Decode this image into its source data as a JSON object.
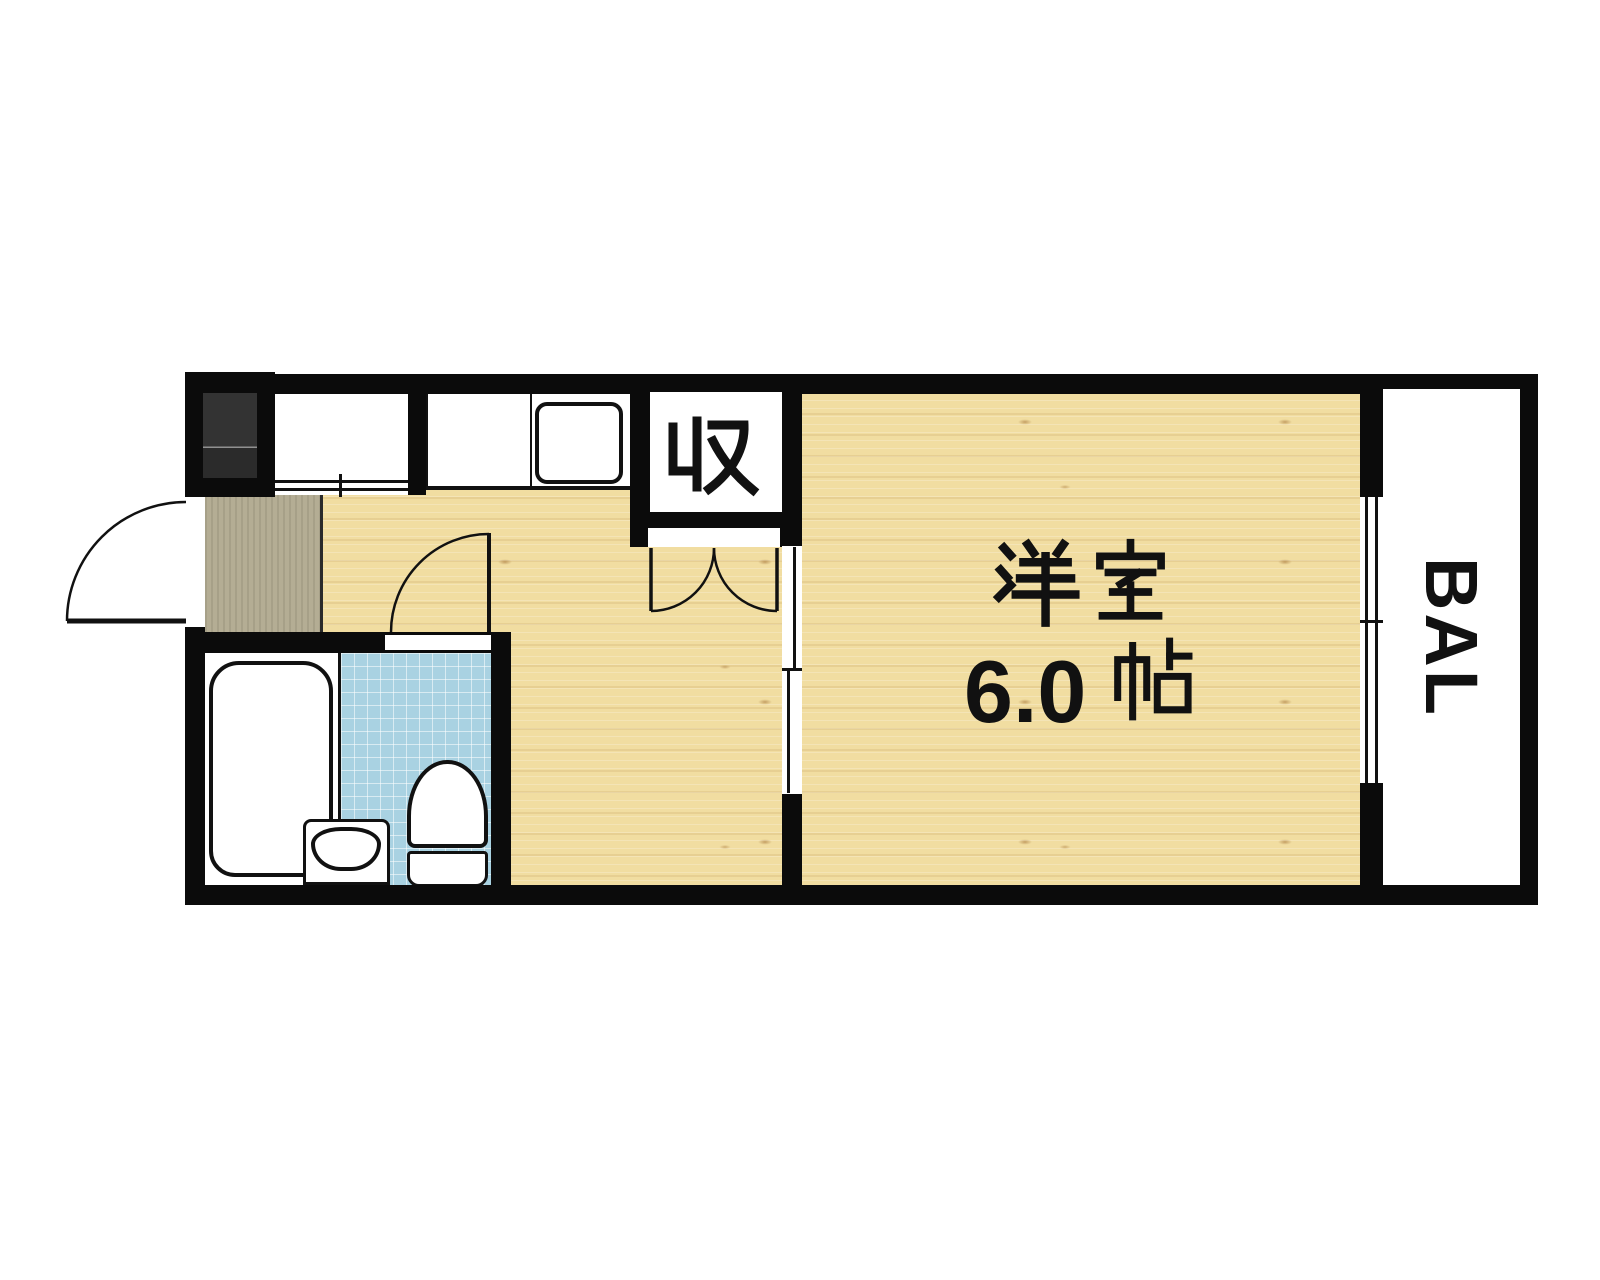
{
  "floor_plan": {
    "labels": {
      "western_room_name": "洋室",
      "western_room_size": "6.0帖",
      "western_room_size_number": "6.0",
      "closet": "収",
      "balcony": "BAL"
    },
    "fixtures": {
      "kitchen_sink": "kitchen-sink",
      "bathtub": "bathtub",
      "toilet": "toilet",
      "washbasin": "washbasin",
      "entrance_door": "entrance-door",
      "bathroom_door": "bathroom-door",
      "closet_double_doors": "closet-double-doors",
      "kitchen_sliding_door": "kitchen-sliding-door",
      "balcony_sliding_window": "balcony-sliding-window",
      "storage_sliding_doors": "storage-sliding-doors",
      "appliance_space": "appliance-space"
    },
    "colors": {
      "wall": "#0b0b0b",
      "outline": "#111111",
      "wood": "#f1dda1",
      "genkan": "#b4ad94",
      "tile": "#a9d2e2",
      "tile-grid": "#ffffff",
      "dark-unit": "#2f2f2f",
      "paper": "#ffffff"
    }
  }
}
